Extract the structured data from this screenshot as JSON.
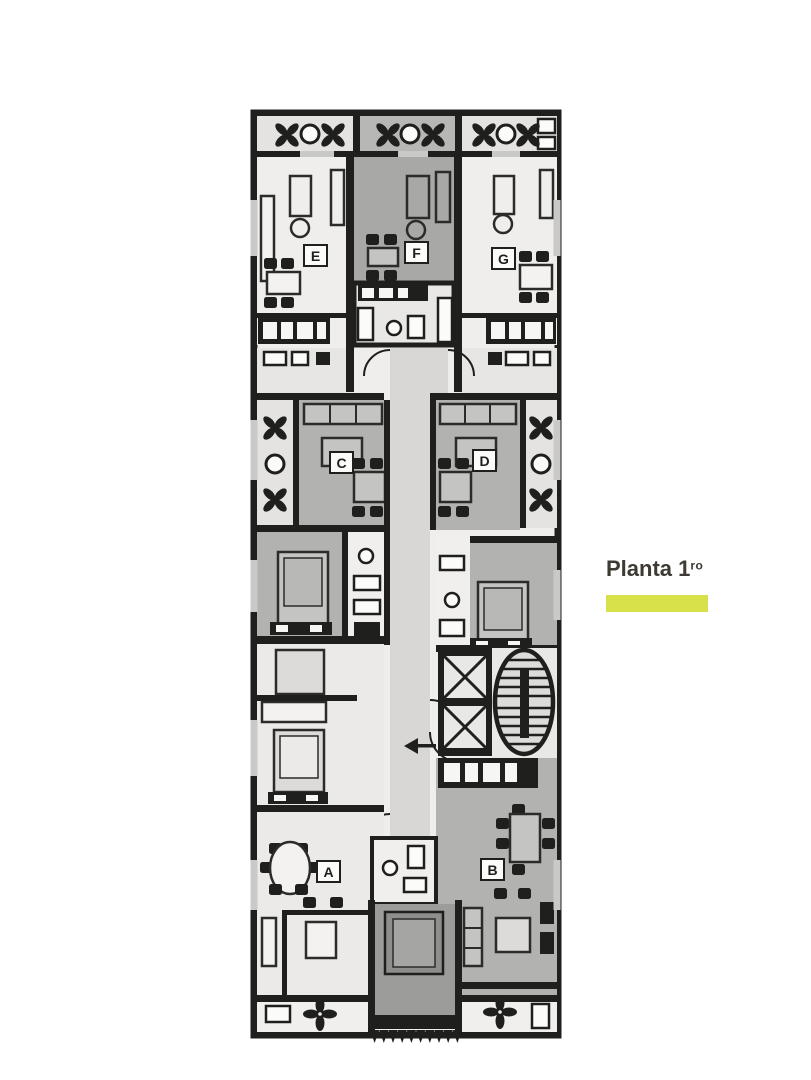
{
  "header": {
    "title": "Planta 1",
    "title_superscript": "ro"
  },
  "floorplan": {
    "units": [
      {
        "label": "E"
      },
      {
        "label": "F"
      },
      {
        "label": "G"
      },
      {
        "label": "C"
      },
      {
        "label": "D"
      },
      {
        "label": "A"
      },
      {
        "label": "B"
      }
    ],
    "icons": [
      "planter-icon",
      "flower-icon",
      "table-icon",
      "chair-icon",
      "sofa-icon",
      "bed-icon",
      "elevator-icon",
      "staircase-icon",
      "kitchen-counter-icon",
      "bathroom-fixture-icon",
      "direction-arrow-icon",
      "door-arc-icon"
    ],
    "colors": {
      "wall": "#1f1f1d",
      "room_white": "#efeeec",
      "room_gray": "#b2b2b0",
      "room_dark_gray": "#a8a8a6",
      "bedroom_dark": "#9c9c9a",
      "corridor": "#d8d7d5",
      "balcony": "#e4e3e1",
      "accent_lime": "#d9e14a",
      "title_text": "#3e3a34"
    }
  }
}
